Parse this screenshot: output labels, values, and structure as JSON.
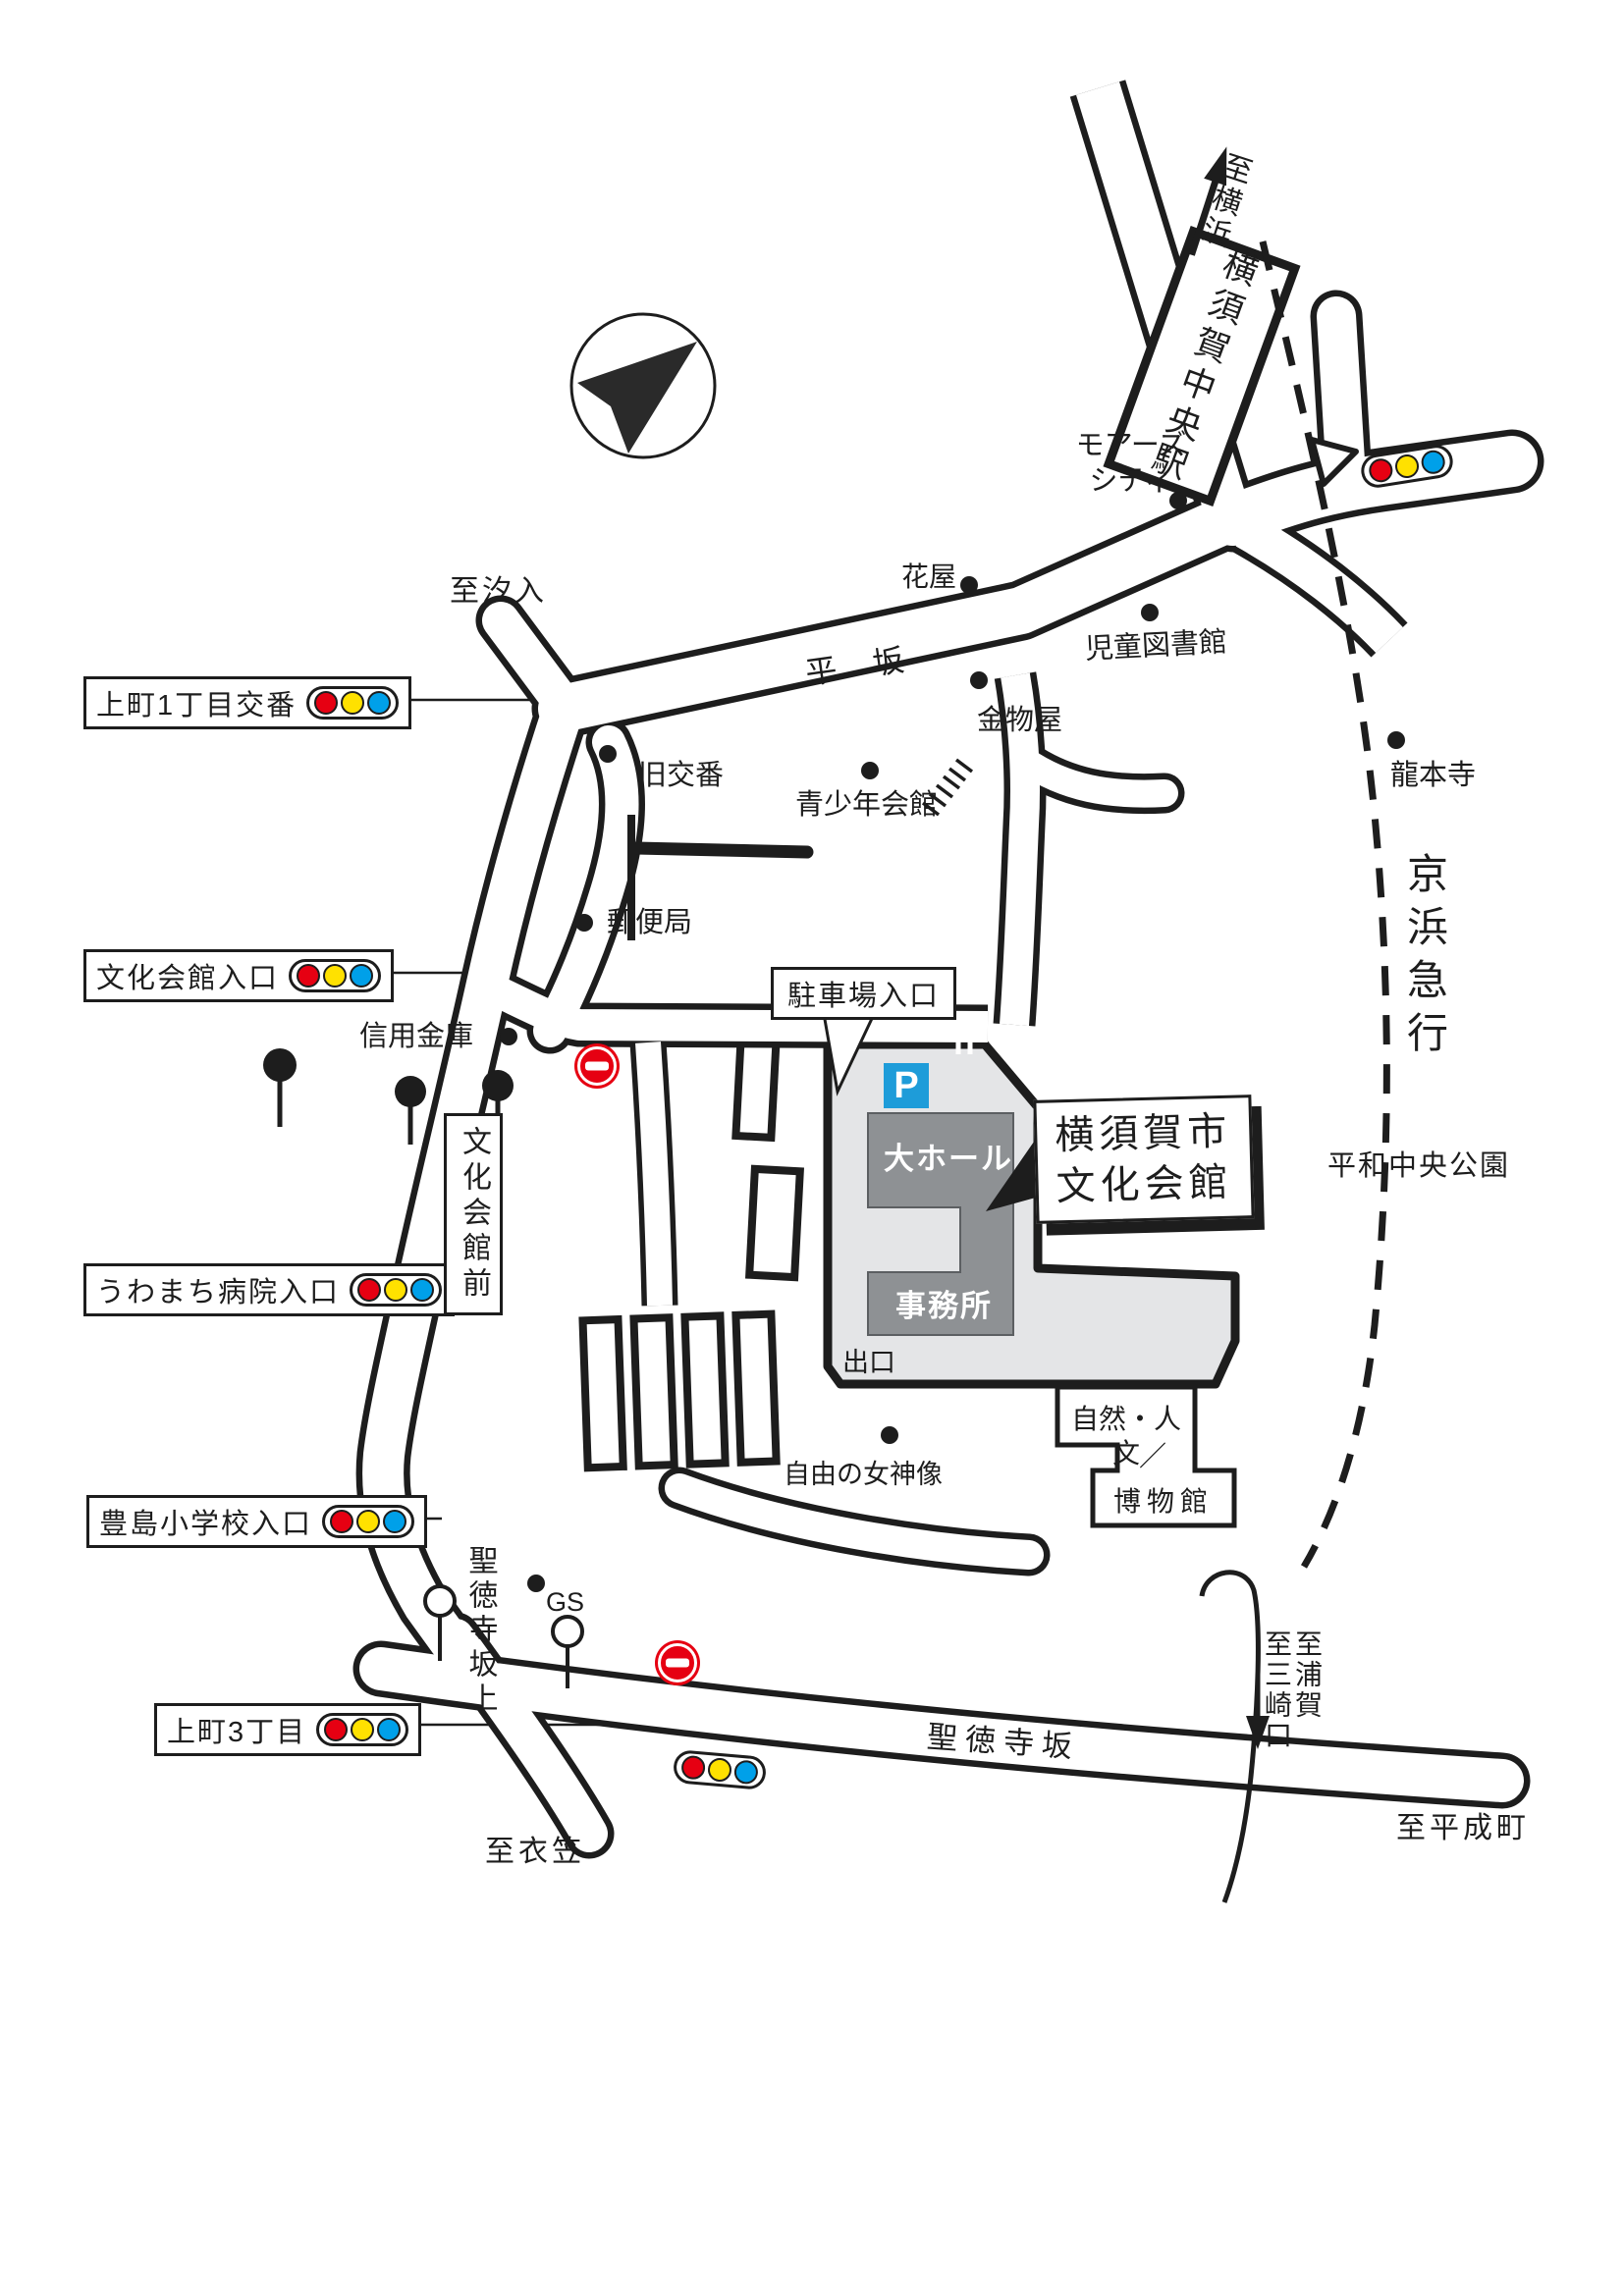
{
  "title": "横須賀市文化会館 アクセスマップ",
  "labels": {
    "uemachi1": "上町1丁目交番",
    "bunkakaikan_iriguchi": "文化会館入口",
    "uwamachi_hospital": "うわまち病院入口",
    "toshima_elementary": "豊島小学校入口",
    "uemachi3": "上町3丁目",
    "chushajo_iriguchi": "駐車場入口",
    "bunkakaikan_mae": "文化会館前",
    "hall_name": "横須賀市\n文化会館",
    "o_hall": "大ホール",
    "jimusho": "事務所",
    "deguchi": "出口",
    "parking_p": "P",
    "shioiri": "至汐入",
    "hirasaka": "平 坂",
    "hanaya": "花屋",
    "jido_toshokan": "児童図書館",
    "kanamonoya": "金物屋",
    "seishonen": "青少年会館",
    "kyu_koban": "旧交番",
    "yubinkyoku": "郵便局",
    "shinyo_kinko": "信用金庫",
    "mores_city": "モアーズ\nシティ",
    "yokosuka_chuo_sta": "横須賀中央駅",
    "shi_yokohama": "至横浜",
    "ryuhonji": "龍本寺",
    "keihin_kyuko": "京浜急行",
    "heiwa_park": "平和中央公園",
    "jiyu_megami": "自由の女神像",
    "gs": "GS",
    "shotokuji_sakaue": "聖徳寺坂上",
    "shotokuji_zaka": "聖徳寺坂",
    "shi_kinugasa": "至衣笠",
    "shi_heiseicho": "至平成町",
    "shi_uraga": "至浦賀",
    "shi_misakiguchi": "至三崎口",
    "museum_line1": "自然・人文",
    "museum_slash": "／",
    "museum_line2": "博物館"
  },
  "icons": {
    "compass": "north-arrow-in-circle",
    "traffic_light": "red-yellow-blue-signal",
    "no_entry": "no-entry-sign",
    "tree": "roadside-tree",
    "lamp": "street-lamp",
    "parking": "parking-P-square",
    "rail": "dashed-railway-line",
    "poi_dot": "black-dot-marker"
  },
  "colors": {
    "ink": "#1d1d1d",
    "grounds_gray": "#e4e5e7",
    "building_gray": "#8e9194",
    "parking_blue": "#1e9cd9",
    "signal_red": "#e60012",
    "signal_yellow": "#ffe100",
    "signal_blue": "#00a0e9",
    "no_entry_red": "#e60012"
  }
}
